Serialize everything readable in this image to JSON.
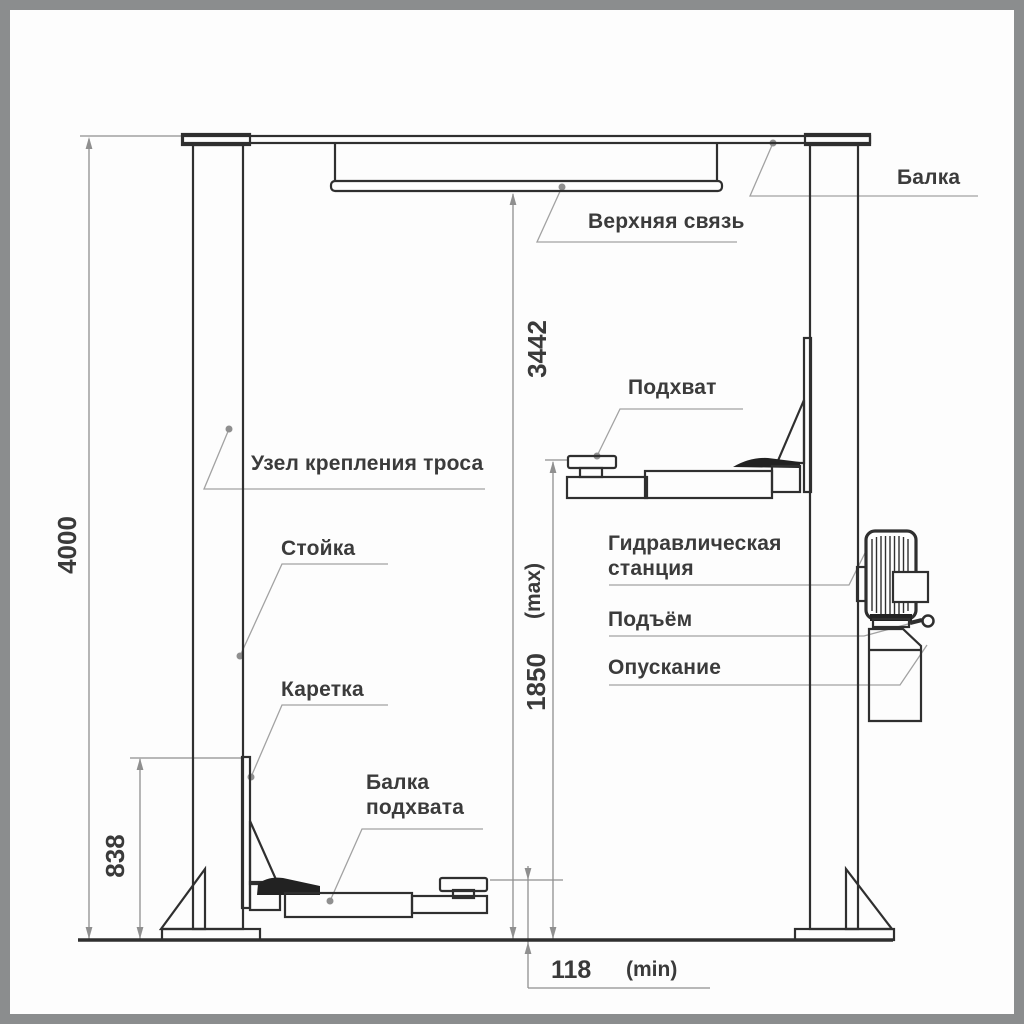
{
  "diagram": {
    "title": "Two-post car lift schematic",
    "labels": {
      "beam": "Балка",
      "upper_tie": "Верхняя связь",
      "pad": "Подхват",
      "cable_mount": "Узел крепления троса",
      "column": "Стойка",
      "carriage": "Каретка",
      "pad_beam_line1": "Балка",
      "pad_beam_line2": "подхвата",
      "hydraulic_line1": "Гидравлическая",
      "hydraulic_line2": "станция",
      "lift": "Подъём",
      "lower": "Опускание"
    },
    "dimensions": {
      "total_height": "4000",
      "tie_height": "3442",
      "max_pad_height": "1850",
      "max_suffix": "(max)",
      "carriage_height": "838",
      "min_pad_height": "118",
      "min_suffix": "(min)"
    },
    "colors": {
      "border": "#8b8d8e",
      "background": "#fdfdfd",
      "line": "#2f2f2f",
      "dim": "#8f8f8f",
      "text": "#3a3a3a"
    }
  }
}
